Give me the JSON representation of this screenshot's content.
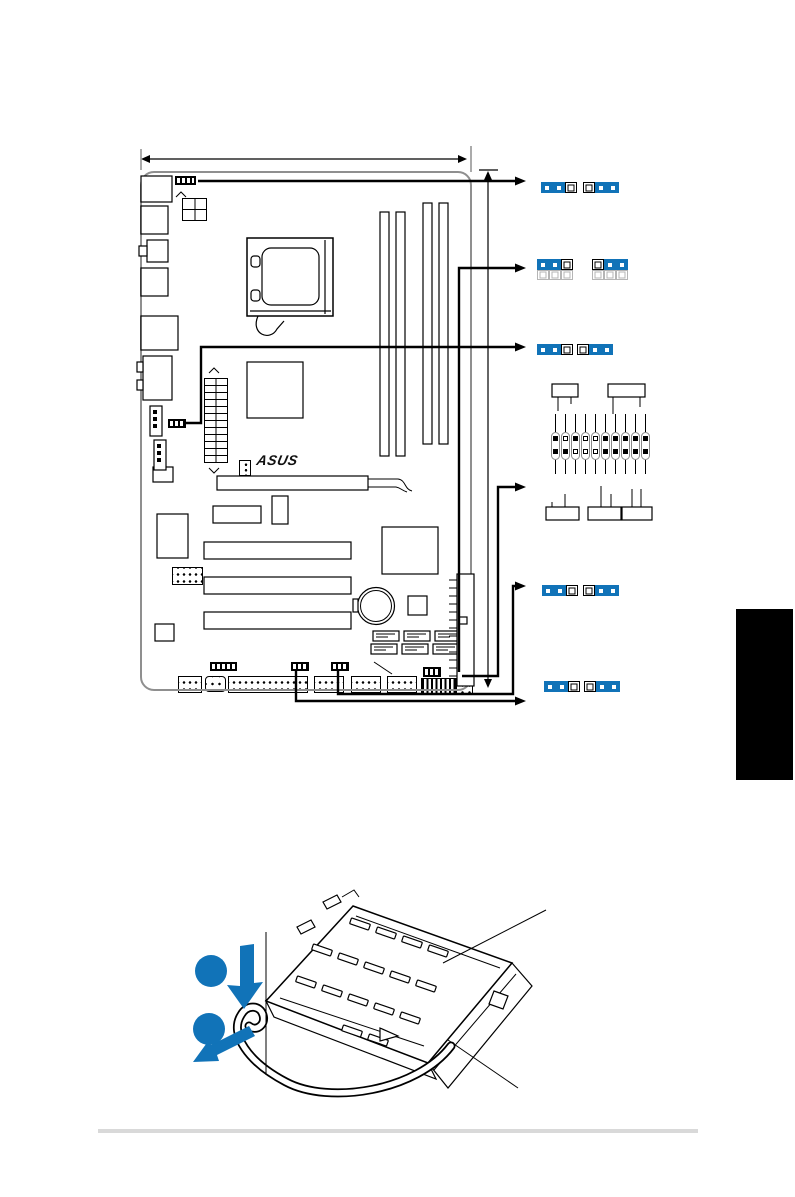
{
  "page": {
    "width_px": 795,
    "height_px": 1197,
    "background": "#ffffff"
  },
  "colors": {
    "accent_blue": "#1173b8",
    "line_black": "#000000",
    "board_edge_gray": "#8f8f8f",
    "ghost_gray": "#b5b5b5",
    "footer_rule_gray": "#d9d9d9",
    "chapter_tab_black": "#000000"
  },
  "board": {
    "brand_logo": "ASUS",
    "dimm_slot_count": 4,
    "sata_port_count": 6,
    "pci_slot_count": 3
  },
  "jumper_diagrams": {
    "rows": [
      {
        "id": "row1",
        "y": 182,
        "jumpers": [
          {
            "x": 541,
            "cap": "1-2",
            "open_row": false
          },
          {
            "x": 583,
            "cap": "2-3",
            "open_row": false
          }
        ]
      },
      {
        "id": "row2",
        "y": 259,
        "jumpers": [
          {
            "x": 537,
            "cap": "1-2",
            "open_row": true
          },
          {
            "x": 592,
            "cap": "2-3",
            "open_row": true
          }
        ]
      },
      {
        "id": "row3",
        "y": 344,
        "jumpers": [
          {
            "x": 537,
            "cap": "1-2",
            "open_row": false
          },
          {
            "x": 577,
            "cap": "2-3",
            "open_row": false
          }
        ]
      },
      {
        "id": "row4",
        "y": 585,
        "jumpers": [
          {
            "x": 542,
            "cap": "1-2",
            "open_row": false
          },
          {
            "x": 583,
            "cap": "2-3",
            "open_row": false
          }
        ]
      },
      {
        "id": "row5",
        "y": 681,
        "jumpers": [
          {
            "x": 544,
            "cap": "1-2",
            "open_row": false
          },
          {
            "x": 584,
            "cap": "2-3",
            "open_row": false
          }
        ]
      }
    ]
  },
  "front_panel_header": {
    "columns": 10,
    "rows": 2,
    "top_pins": [
      1,
      0,
      1,
      0,
      0,
      1,
      1,
      1,
      1,
      1
    ],
    "bottom_pins": [
      1,
      1,
      0,
      0,
      0,
      1,
      1,
      1,
      1,
      1
    ]
  },
  "socket_figure": {
    "step_badges": 2,
    "arrow_icons": [
      "press-down-arrow",
      "pull-lever-arrow"
    ]
  }
}
